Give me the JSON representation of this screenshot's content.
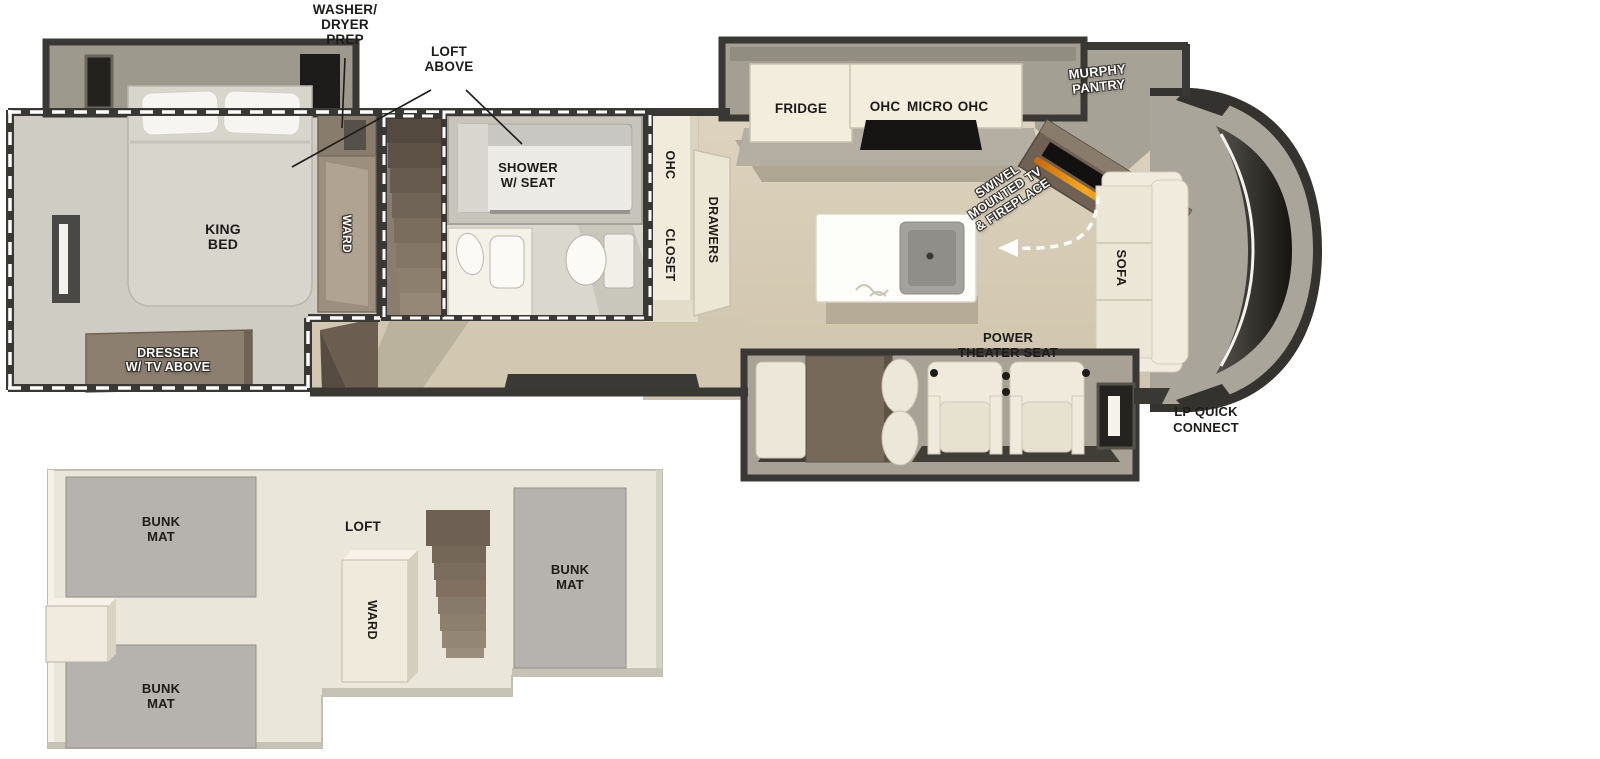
{
  "plan_title": "fifth-wheel RV floorplan with rear king bedroom, loft and front sofa",
  "palette": {
    "wall": "#3a3835",
    "wood_floor": "#d9cfba",
    "gray_floor": "#cfccc3",
    "slide_gray": "#a39e92",
    "cream": "#efeadb",
    "brown": "#77695a",
    "mat_gray": "#b6b3ae",
    "flame_accent": "#f59a10",
    "text_black": "#1d1c1a",
    "text_white": "#ffffff"
  },
  "main_floor": {
    "callouts": {
      "washer_dryer_prep": "WASHER/\nDRYER\nPREP",
      "loft_above": "LOFT\nABOVE",
      "lp_quick_connect": "LP QUICK\nCONNECT"
    },
    "bedroom": {
      "king_bed": "KING\nBED",
      "dresser": "DRESSER\nW/ TV ABOVE",
      "ward": "WARD"
    },
    "bathroom": {
      "shower": "SHOWER\nW/ SEAT"
    },
    "storage": {
      "ohc": "OHC",
      "closet": "CLOSET",
      "drawers": "DRAWERS"
    },
    "kitchen": {
      "fridge": "FRIDGE",
      "ohc_left": "OHC",
      "micro": "MICRO",
      "ohc_right": "OHC",
      "murphy_pantry": "MURPHY\nPANTRY",
      "swivel_tv_fireplace": "SWIVEL\nMOUNTED TV\n& FIREPLACE"
    },
    "living": {
      "sofa": "SOFA",
      "power_theater_seat": "POWER\nTHEATER SEAT"
    }
  },
  "loft_plan": {
    "bunk_mat_top": "BUNK\nMAT",
    "bunk_mat_bottom": "BUNK\nMAT",
    "bunk_mat_right": "BUNK\nMAT",
    "loft": "LOFT",
    "ward": "WARD"
  }
}
